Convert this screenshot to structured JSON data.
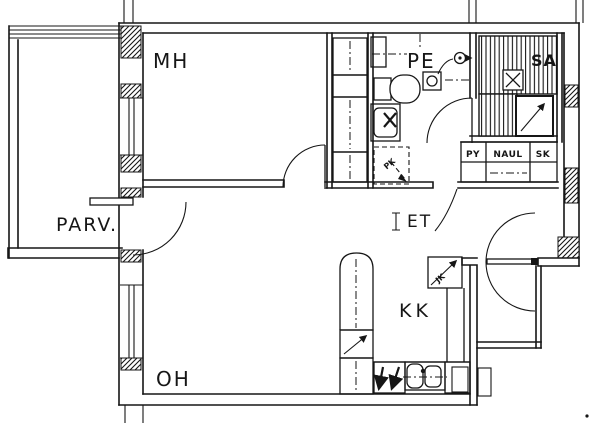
{
  "document": {
    "type": "apartment-floor-plan"
  },
  "rooms": [
    {
      "id": "mh",
      "label": "MH"
    },
    {
      "id": "parv",
      "label": "PARV."
    },
    {
      "id": "oh",
      "label": "OH"
    },
    {
      "id": "kk",
      "label": "KK"
    },
    {
      "id": "et",
      "label": "ET"
    },
    {
      "id": "pe",
      "label": "PE"
    },
    {
      "id": "sa",
      "label": "SA"
    }
  ],
  "closet_row": [
    {
      "label": "PY"
    },
    {
      "label": "NAUL"
    },
    {
      "label": "SK"
    }
  ],
  "appliance_marks": [
    {
      "label": "PK"
    },
    {
      "label": "JK"
    }
  ],
  "colors": {
    "line": "#161616",
    "paper": "#ffffff"
  }
}
